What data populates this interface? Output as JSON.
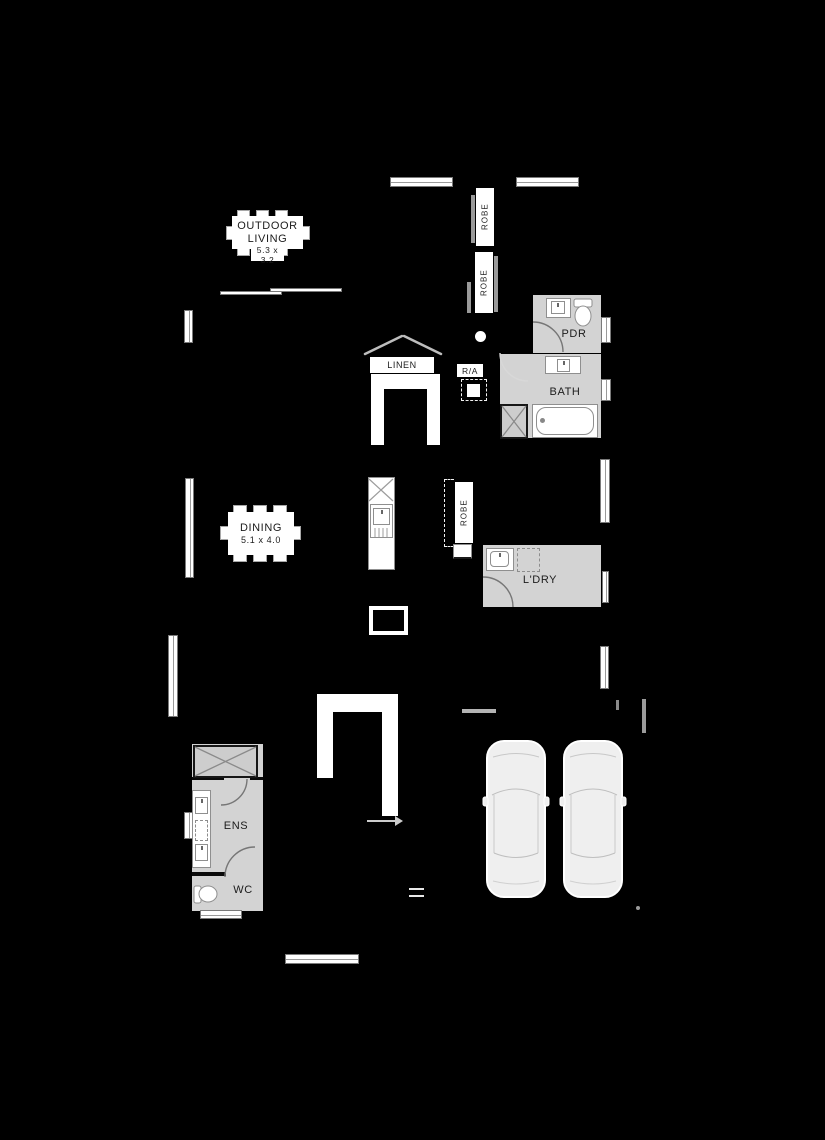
{
  "meta": {
    "type": "residential floor plan",
    "background": "#000000"
  },
  "colors": {
    "background": "#000000",
    "wet_area_fill": "#d3d3d3",
    "fixture_white": "#ffffff",
    "fixture_border": "#8f8f8f",
    "label_text": "#1c1c1c"
  },
  "labels": {
    "outdoor_living_line1": "OUTDOOR",
    "outdoor_living_line2": "LIVING",
    "outdoor_living_dims": "5.3 x 3.2",
    "dining": "DINING",
    "dining_dims": "5.1 x 4.0",
    "linen": "LINEN",
    "return_air": "R/A",
    "robe_1": "ROBE",
    "robe_2": "ROBE",
    "robe_3": "ROBE",
    "powder": "PDR",
    "bath": "BATH",
    "laundry": "L'DRY",
    "ensuite": "ENS",
    "wc": "WC"
  }
}
